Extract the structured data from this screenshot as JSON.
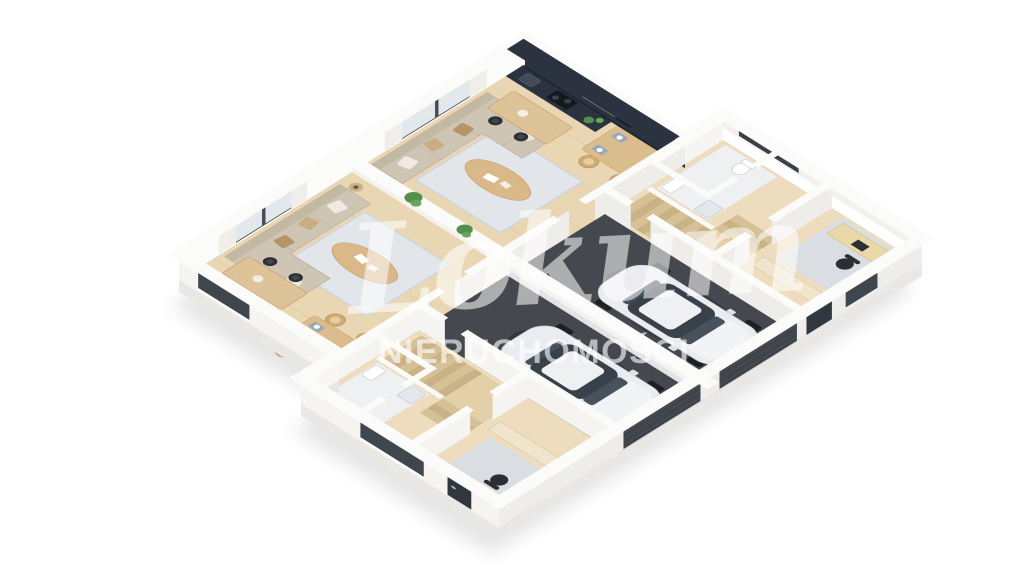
{
  "meta": {
    "background": "#ffffff",
    "render_type": "isometric-3d-floor-plan"
  },
  "watermark": {
    "script_text": "Lokum",
    "caps_text": "NIERUCHOMOŚCI"
  },
  "palette": {
    "wall_top": "#fbfbf9",
    "wall_face": "#f5f4f1",
    "wall_face_front": "#efedea",
    "slab": "#eae8e4",
    "floor_wood": "#e9d7b3",
    "floor_wood_rear": "#eddcbd",
    "garage_floor": "#45494f",
    "kitchen_dark": "#2b3240",
    "sofa": "#cfc5b4",
    "rug_living": "#e2e6eb",
    "rug_office": "#dadee3",
    "table_wood": "#dbbc8c",
    "chair_wood": "#d0aa74",
    "island_wood": "#dec399",
    "stair_wood": "#d6c096",
    "car_body": "#eaecef",
    "car_glass": "#39424b",
    "garage_door": "#3f444b",
    "plant_green": "#55904a",
    "placemat_blue": "#96a8bf"
  },
  "scene": {
    "units": [
      {
        "side": "left"
      },
      {
        "side": "right"
      }
    ],
    "objects": [
      "living-room-sofa",
      "coffee-table",
      "living-rug",
      "floor-lamp",
      "dining-table",
      "dining-chairs",
      "kitchen-counter",
      "kitchen-island",
      "bar-stools",
      "staircase",
      "bathroom-fixtures",
      "home-office-desk",
      "office-chair",
      "office-rug",
      "potted-plants",
      "party-wall-planters",
      "garage",
      "car",
      "garage-door",
      "window-curtains",
      "front-door"
    ]
  }
}
